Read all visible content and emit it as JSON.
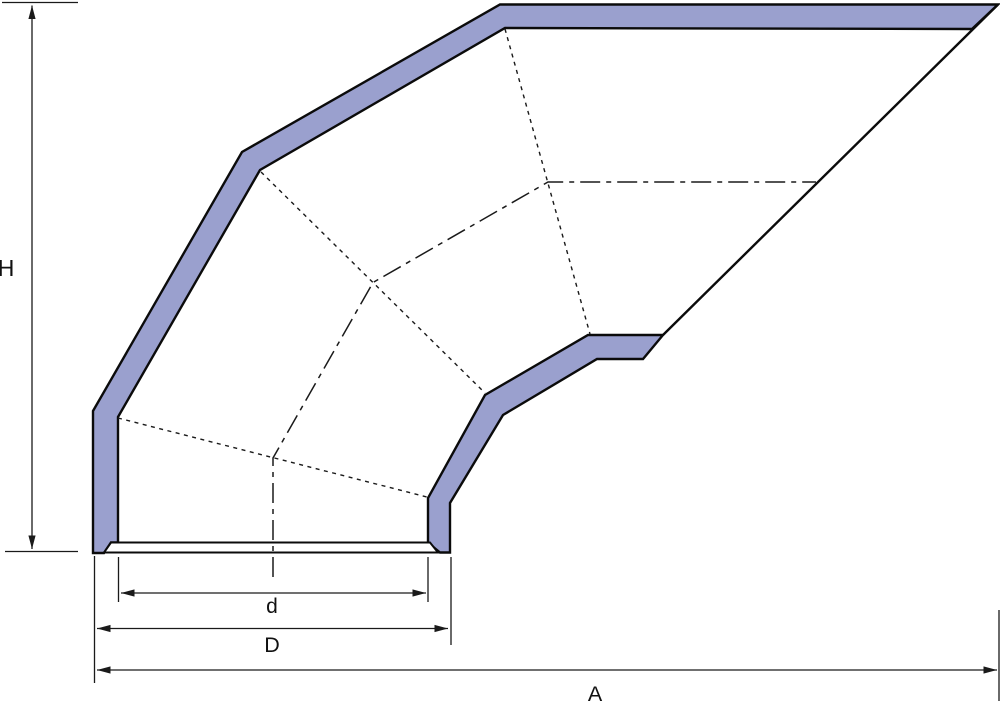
{
  "drawing_title": "Segmented elbow hood - dimensioned side view",
  "canvas": {
    "width": 1000,
    "height": 702,
    "background": "#ffffff"
  },
  "style": {
    "band_fill": "#9aa0ce",
    "collar_fill": "#ffffff",
    "outline_color": "#0b0b0b",
    "thin_color": "#1a1a1a",
    "outline_width": 2.4,
    "collar_width": 2,
    "thin_width": 1.3,
    "dotted_dash": "4 4.5",
    "center_dash": "20 6 5 6"
  },
  "labels": [
    {
      "name": "label-height-H",
      "text": "H",
      "x": 6,
      "y": 276,
      "size": 23
    },
    {
      "name": "label-inner-diameter-d",
      "text": "d",
      "x": 272,
      "y": 613,
      "size": 21
    },
    {
      "name": "label-outer-diameter-D",
      "text": "D",
      "x": 272,
      "y": 652,
      "size": 21.5
    },
    {
      "name": "label-overall-width-A",
      "text": "A",
      "x": 595,
      "y": 701,
      "size": 21.5
    }
  ],
  "shapes": [
    {
      "name": "hood-left-and-top-wall-band",
      "type": "polygon",
      "role": "band",
      "points": "93,553 93,411 242,152 500,4.5 998,4.5 972,29 505,28 260,170 118,417 118,542.5 111,542.5 104,553"
    },
    {
      "name": "hood-right-wall-band",
      "type": "polygon",
      "role": "band",
      "points": "428,543 428,498 485,395 588,335 663,335 643,359 597,359 503,415 450,503 450,552.5 440,552.5 429,543.5"
    },
    {
      "name": "base-collar-flange",
      "type": "polygon",
      "role": "collar",
      "points": "111,542.5 430,542.5 438,552.5 104,552.5"
    },
    {
      "name": "hood-right-outer-edge-line",
      "type": "line",
      "role": "outline",
      "points": "663,335 998,4.5"
    },
    {
      "name": "gore-joint-1-hidden-line",
      "type": "polyline",
      "role": "dotted",
      "points": "118,418 427,497"
    },
    {
      "name": "gore-joint-2-hidden-line",
      "type": "polyline",
      "role": "dotted",
      "points": "261,172 485,393"
    },
    {
      "name": "gore-joint-3-hidden-line",
      "type": "polyline",
      "role": "dotted",
      "points": "505,29 590,334"
    },
    {
      "name": "elbow-centerline",
      "type": "polyline",
      "role": "centerline",
      "points": "273,577 273,458 373,282.5 548,182 816,182"
    },
    {
      "name": "dim-H-top-tick",
      "type": "line",
      "role": "thin",
      "points": "2,2.5 78,2.5"
    },
    {
      "name": "dim-H-bottom-tick",
      "type": "line",
      "role": "thin",
      "points": "5,551.5 78,551.5"
    },
    {
      "name": "dim-H-arrow-line",
      "type": "line",
      "role": "dim",
      "points": "32,5.5 32,549"
    },
    {
      "name": "ext-line-d-left",
      "type": "line",
      "role": "thin",
      "points": "118.5,557 118.5,602"
    },
    {
      "name": "ext-line-d-right",
      "type": "line",
      "role": "thin",
      "points": "428,557 428,602"
    },
    {
      "name": "ext-line-D-left",
      "type": "line",
      "role": "thin",
      "points": "94.5,556 94.5,683"
    },
    {
      "name": "ext-line-D-right",
      "type": "line",
      "role": "thin",
      "points": "451,557 451,645"
    },
    {
      "name": "ext-line-A-right",
      "type": "line",
      "role": "thin",
      "points": "999,610 999,701"
    },
    {
      "name": "dim-d-arrow-line",
      "type": "line",
      "role": "dim",
      "points": "121,593 426,593"
    },
    {
      "name": "dim-D-arrow-line",
      "type": "line",
      "role": "dim",
      "points": "97,628.5 448,628.5"
    },
    {
      "name": "dim-A-arrow-line",
      "type": "line",
      "role": "dim",
      "points": "97,670 997,670"
    }
  ]
}
